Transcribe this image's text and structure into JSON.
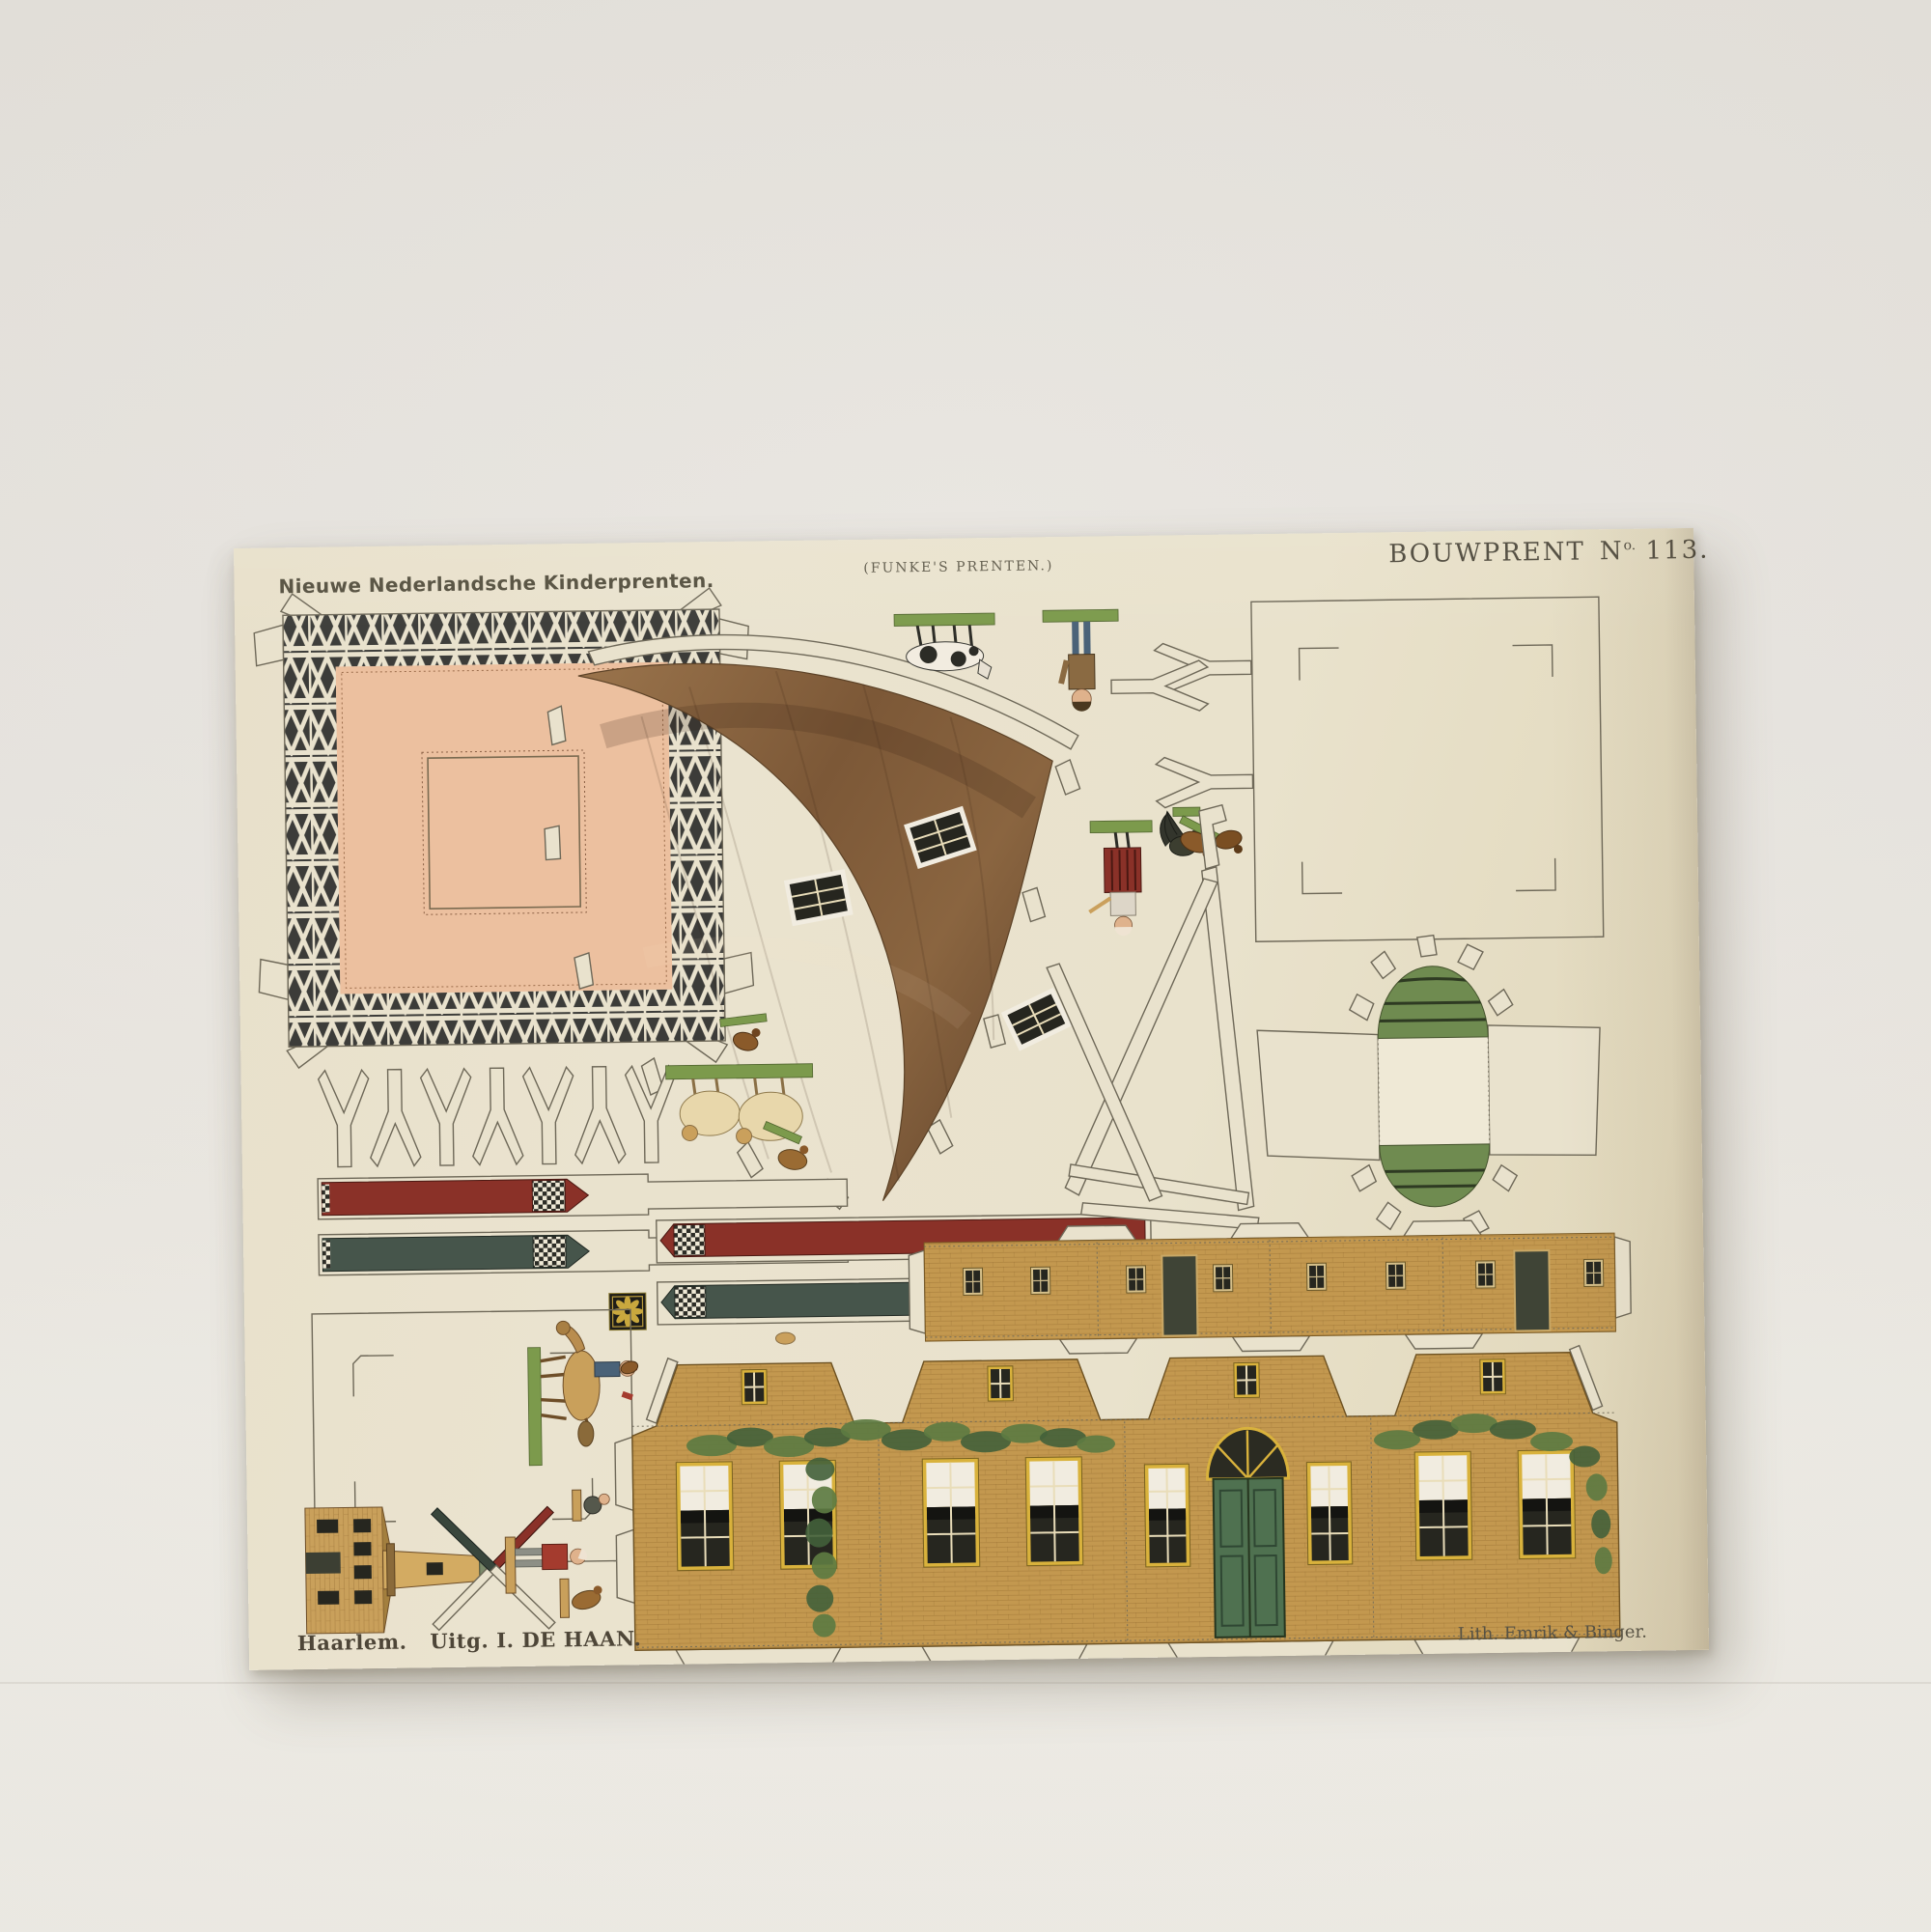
{
  "sheet": {
    "header_left": "Nieuwe Nederlandsche Kinderprenten.",
    "header_center": "(FUNKE'S PRENTEN.)",
    "header_right": {
      "word": "BOUWPRENT",
      "no": "N",
      "no_sup": "o.",
      "number": "113."
    },
    "footer_left": "Haarlem.   Uitg. I. DE HAAN.",
    "footer_right": "Lith. Emrik & Binger."
  },
  "colors": {
    "paper": "#e9e2cd",
    "ink": "#6e6858",
    "inktext": "#4e4839",
    "salmon": "#ecc09f",
    "trussdark": "#3c3c39",
    "cone1": "#9a744c",
    "cone2": "#6e4e32",
    "windark": "#26261f",
    "winwhite": "#f1ece0",
    "ochre": "#c3984f",
    "frameyellow": "#d9b23c",
    "doorgreen": "#4f7150",
    "ivy1": "#5d7b42",
    "ivy2": "#42603a",
    "sailred": "#8a3128",
    "sailgreen": "#46554b",
    "capgreen": "#6f8b50",
    "grass": "#7c9a4c",
    "tanfig": "#c9a05b",
    "cream": "#e8d7ab",
    "red": "#a43b2e",
    "blue": "#4a6278",
    "grey": "#8d8f86",
    "flesh": "#dfb28c",
    "dark": "#2c2c26"
  }
}
